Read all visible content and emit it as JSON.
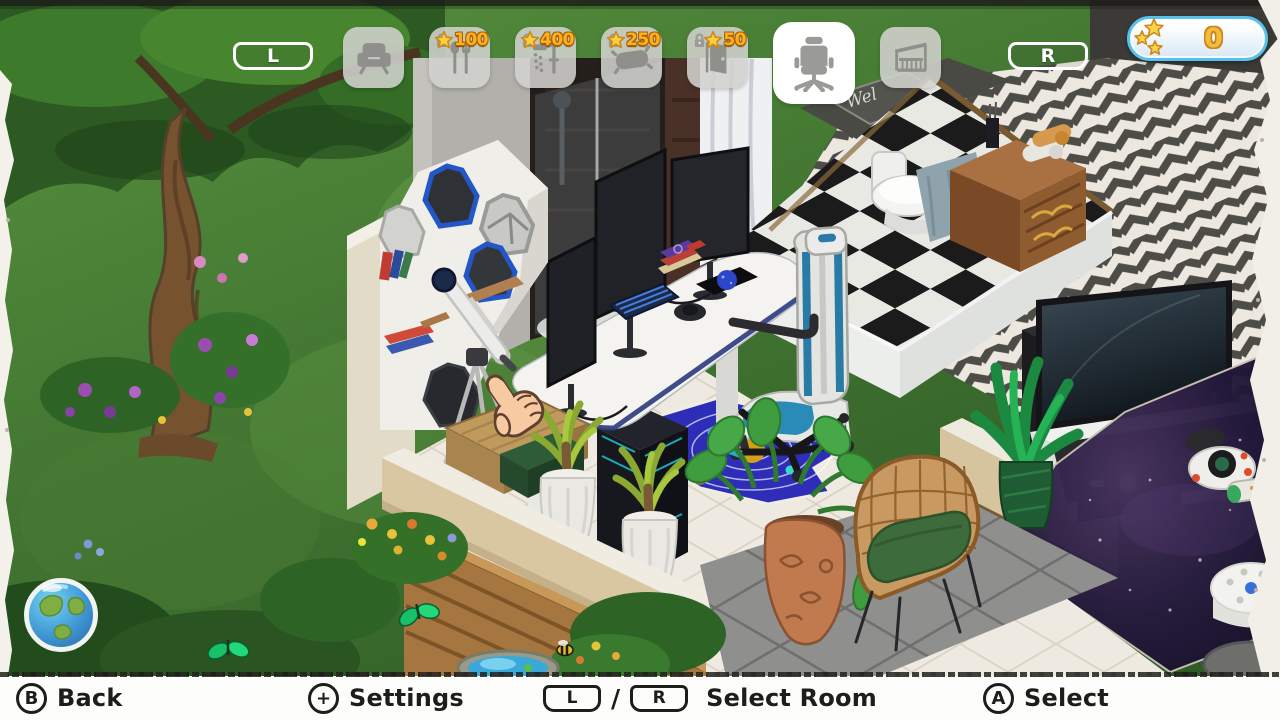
{
  "top_bar": {
    "shoulder_left": "L",
    "shoulder_right": "R",
    "tabs": [
      {
        "name": "living-room",
        "icon": "armchair-icon",
        "locked": false,
        "selected": false
      },
      {
        "name": "kitchen",
        "icon": "cutlery-icon",
        "locked": true,
        "selected": false,
        "price": "100"
      },
      {
        "name": "bathroom",
        "icon": "shower-icon",
        "locked": true,
        "selected": false,
        "price": "400"
      },
      {
        "name": "bedroom",
        "icon": "pillow-icon",
        "locked": true,
        "selected": false,
        "price": "250"
      },
      {
        "name": "hallway",
        "icon": "door-icon",
        "locked": true,
        "selected": false,
        "price": "50"
      },
      {
        "name": "office",
        "icon": "office-chair-icon",
        "locked": false,
        "selected": true
      },
      {
        "name": "balcony",
        "icon": "balcony-icon",
        "locked": false,
        "selected": false
      }
    ]
  },
  "currency": {
    "amount": "0",
    "icon": "stars-icon"
  },
  "footer": {
    "back": {
      "button": "B",
      "label": "Back"
    },
    "settings": {
      "button": "+",
      "label": "Settings"
    },
    "select_room": {
      "button_l": "L",
      "separator": "/",
      "button_r": "R",
      "label": "Select Room"
    },
    "select": {
      "button": "A",
      "label": "Select"
    }
  },
  "scene": {
    "welcome_mat_text": "Wel"
  },
  "icons": {
    "armchair-icon": "armchair glyph",
    "cutlery-icon": "spoon and fork glyph",
    "shower-icon": "shower glyph",
    "pillow-icon": "pillow glyph",
    "door-icon": "door glyph",
    "office-chair-icon": "office chair glyph",
    "balcony-icon": "balcony glyph",
    "lock-icon": "padlock",
    "star-icon": "gold star",
    "globe-icon": "earth globe map button",
    "hand-cursor-icon": "pointing hand selection cursor"
  },
  "colors": {
    "accent_blue": "#54c2ec",
    "price_orange": "#ffb120",
    "star_gold": "#ffcf3e",
    "footer_text": "#1d1d1b",
    "tab_grey": "#d2d2ce",
    "selected_tab": "#ffffff"
  }
}
